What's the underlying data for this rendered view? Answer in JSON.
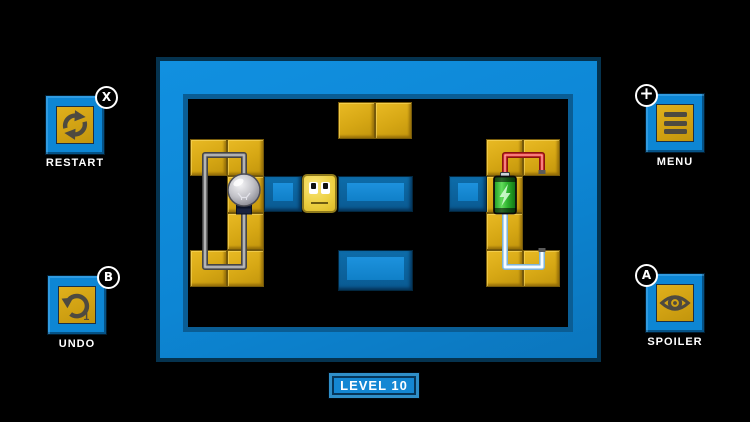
{
  "level_badge": {
    "label": "LEVEL 10"
  },
  "buttons": {
    "restart": {
      "label": "RESTART",
      "badge": "X"
    },
    "undo": {
      "label": "UNDO",
      "badge": "B",
      "counter": "1"
    },
    "menu": {
      "label": "MENU",
      "badge": "+"
    },
    "spoiler": {
      "label": "SPOILER",
      "badge": "A"
    }
  },
  "colors": {
    "background": "#000000",
    "frame_blue": "#0d86d4",
    "frame_dark_blue": "#0a5d94",
    "tile_yellow": "#d6a714",
    "character_yellow": "#eccf40",
    "slot_blue": "#1588d6",
    "wire_gray": "#989898",
    "wire_red": "#ef4040",
    "wire_light_blue": "#eef8ff",
    "battery_green": "#2eb832",
    "icon_gray": "#4e4a40"
  },
  "board": {
    "grid": {
      "origin_x": 190,
      "origin_y": 102,
      "tile": 37
    },
    "yellow_tiles": [
      [
        4,
        0
      ],
      [
        5,
        0
      ],
      [
        0,
        1
      ],
      [
        1,
        1
      ],
      [
        1,
        2
      ],
      [
        1,
        3
      ],
      [
        0,
        4
      ],
      [
        1,
        4
      ],
      [
        8,
        1
      ],
      [
        9,
        1
      ],
      [
        8,
        2
      ],
      [
        8,
        3
      ],
      [
        8,
        4
      ],
      [
        9,
        4
      ]
    ],
    "slots": [
      {
        "col": 2,
        "row": 2,
        "w": 1,
        "h": 36
      },
      {
        "col": 4,
        "row": 2,
        "w": 2,
        "h": 36
      },
      {
        "col": 7,
        "row": 2,
        "w": 1,
        "h": 36
      },
      {
        "col": 4,
        "row": 4,
        "w": 2,
        "h": 41
      }
    ],
    "character": {
      "col": 3,
      "row": 2
    },
    "bulb": {
      "x": 244,
      "y": 190
    },
    "battery": {
      "x": 505,
      "y": 195
    },
    "wires": {
      "gray": "M244 178 L244 155 L205 155 L205 267 L244 267 L244 212",
      "red": "M505 176 L505 155 L542 155 L542 172",
      "blue": "M505 214 L505 267 L542 267 L542 250"
    }
  }
}
